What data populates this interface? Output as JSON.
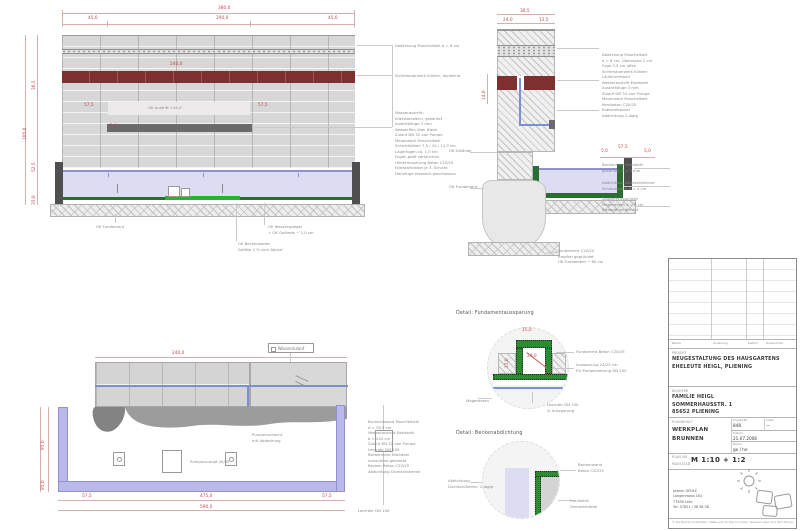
{
  "colors": {
    "dim_red": "#b84b4b",
    "note_gray": "#8a8a8a",
    "water_lavender": "#dcdcf2",
    "basin_purple": "#b9b9ea",
    "liner_green": "#2c6e2f",
    "brick_red": "#7e3030",
    "steel_gray": "#4f4f4f",
    "pipe_blue": "#7b8fd4"
  },
  "details": {
    "d1_title": "Detail: Fundamentaussparung",
    "d2_title": "Detail: Beckenabdichtung"
  },
  "plan": {
    "supply_label": "Wasserzulauf"
  },
  "dims": [
    {
      "text": "380,0",
      "style": "left:218px;top:7px"
    },
    {
      "text": "45,0",
      "style": "left:88px;top:17px"
    },
    {
      "text": "290,0",
      "style": "left:216px;top:17px"
    },
    {
      "text": "45,0",
      "style": "left:328px;top:17px"
    },
    {
      "text": "240,0",
      "style": "left:170px;top:63px"
    },
    {
      "text": "57,5",
      "style": "left:84px;top:104px"
    },
    {
      "text": "57,5",
      "style": "left:258px;top:104px"
    },
    {
      "text": "2,0",
      "style": "left:110px;top:125px"
    },
    {
      "text": "36,5",
      "style": "left:33px;top:90px;transform:rotate(-90deg)"
    },
    {
      "text": "105,0",
      "style": "left:24px;top:140px;transform:rotate(-90deg)"
    },
    {
      "text": "52,5",
      "style": "left:33px;top:172px;transform:rotate(-90deg)"
    },
    {
      "text": "35,0",
      "style": "left:33px;top:205px;transform:rotate(-90deg)"
    },
    {
      "text": "36,5",
      "style": "left:520px;top:10px"
    },
    {
      "text": "24,0",
      "style": "left:503px;top:19px"
    },
    {
      "text": "12,5",
      "style": "left:539px;top:19px"
    },
    {
      "text": "14,0",
      "style": "left:483px;top:100px;transform:rotate(-90deg)"
    },
    {
      "text": "5,0",
      "style": "left:601px;top:150px"
    },
    {
      "text": "57,5",
      "style": "left:618px;top:146px"
    },
    {
      "text": "5,0",
      "style": "left:644px;top:150px"
    },
    {
      "text": "240,0",
      "style": "left:172px;top:352px"
    },
    {
      "text": "95,0",
      "style": "left:42px;top:450px;transform:rotate(-90deg)"
    },
    {
      "text": "85,0",
      "style": "left:42px;top:490px;transform:rotate(-90deg)"
    },
    {
      "text": "57,5",
      "style": "left:82px;top:495px"
    },
    {
      "text": "475,0",
      "style": "left:200px;top:495px"
    },
    {
      "text": "57,5",
      "style": "left:322px;top:495px"
    },
    {
      "text": "590,0",
      "style": "left:200px;top:506px"
    },
    {
      "text": "15,0",
      "style": "left:522px;top:329px"
    },
    {
      "text": "24,0",
      "style": "left:527px;top:355px"
    },
    {
      "text": "15,0",
      "style": "left:506px;top:368px;transform:rotate(-90deg)"
    }
  ],
  "notes": [
    {
      "text": "Abdeckung Muschelkalk d = 8 cm",
      "style": "left:395px;top:43px"
    },
    {
      "text": "Sichtmauerwerk Klinker, dunkelrot",
      "style": "left:395px;top:73px"
    },
    {
      "text": "Wasseraustritt:\nEdelstahlblech, gekantet\nAustrittsfuge 3 mm\nWasserfilm über Blech\nZulauf DN 32 von Pumpe\nMauerwerk Muschelkalk\nSchichthöhen 7,5 / 10 / 12,5 cm\nLagerfugen ca. 1,0 cm\nFugen glatt verstrichen\nHintermauerung Beton C20/25\nEdelstahlanker je 3. Schicht\nDehnfuge elastisch geschlossen",
      "style": "left:395px;top:110px"
    },
    {
      "text": "OK Austritt  +45,0",
      "style": "left:148px;top:105px"
    },
    {
      "text": "OK Wasserspiegel\n= OK Gelände − 2,0 cm",
      "style": "left:268px;top:224px"
    },
    {
      "text": "OK Beckenboden\nGefälle 2 % zum Ablauf",
      "style": "left:238px;top:241px"
    },
    {
      "text": "OK Fundament",
      "style": "left:96px;top:224px"
    },
    {
      "text": "Abdeckung Muschelkalk\nd = 8 cm, Überstand 2 cm\nFuge 0,5 cm offen\nSichtmauerwerk Klinker\nLäuferverband\nWasseraustritt Edelstahl\nAustrittsfuge 3 mm\nZulauf DN 32 von Pumpe\nMauerwerk Muschelkalk\nKernbeton C20/25\nEdelstahlanker\nAbdichtung 2-lagig",
      "style": "left:602px;top:52px"
    },
    {
      "text": "Beckenrand Edelstahl\ngekantet, d = 3 mm",
      "style": "left:602px;top:162px"
    },
    {
      "text": "Abdichtung Dichtschlämme\nSchutzestrich d = 4 cm",
      "style": "left:602px;top:180px"
    },
    {
      "text": "Sauberkeitsschicht\nMagerbeton d = 5 cm\nKiesbett verdichtet",
      "style": "left:602px;top:196px"
    },
    {
      "text": "Fundament C20/25\nfrostfrei gegründet\nUK Fundament − 80 cm",
      "style": "left:558px;top:248px"
    },
    {
      "text": "OK Gelände",
      "style": "left:449px;top:148px"
    },
    {
      "text": "OK Fundament",
      "style": "left:449px;top:184px"
    },
    {
      "text": "Brunnenwand Muschelkalk\nd = 36,5 cm\nWasseraustritt Edelstahl\nb = 240 cm\nZulauf DN 32 von Pumpe\nLeerrohr DN 100\nBeckenrand Edelstahl\numlaufend gekantet\nBecken Beton C20/25\nAbdichtung Dichtschlämme",
      "style": "left:368px;top:419px"
    },
    {
      "text": "Pumpensumpf 40/40",
      "style": "left:190px;top:459px"
    },
    {
      "text": "Pumpenschacht\nmit Abdeckung",
      "style": "left:252px;top:432px"
    },
    {
      "text": "Leerrohr DN 100",
      "style": "left:358px;top:508px"
    },
    {
      "text": "Fundament Beton C20/25",
      "style": "left:576px;top:349px"
    },
    {
      "text": "Aussparung 24/25 cm\nfür Pumpenleitung DN 100",
      "style": "left:576px;top:362px"
    },
    {
      "text": "Magerbeton",
      "style": "left:466px;top:398px"
    },
    {
      "text": "Leerrohr DN 100\nin Aussparung",
      "style": "left:547px;top:402px"
    },
    {
      "text": "Abdichtung\nDichtschlämme, 2-lagig",
      "style": "left:448px;top:478px"
    },
    {
      "text": "Beckenwand\nBeton C20/25",
      "style": "left:578px;top:462px"
    },
    {
      "text": "Hohlkehle\nZementmörtel",
      "style": "left:570px;top:498px"
    }
  ],
  "titleblock": {
    "rev_headers": [
      {
        "text": "Name",
        "style": "left:3px;top:82px"
      },
      {
        "text": "Änderung",
        "style": "left:44px;top:82px"
      },
      {
        "text": "Datum",
        "style": "left:79px;top:82px"
      },
      {
        "text": "Gezeichnet",
        "style": "left:97px;top:82px"
      }
    ],
    "project_label": "PROJEKT",
    "project_text": "NEUGESTALTUNG DES HAUSGARTENS\nEHELEUTE HEIGL, PLIENING",
    "client_label": "BAUHERR",
    "client_text": "FAMILIE HEIGL\nSOMMERHAUSSTR. 1\n85652 PLIENING",
    "content_label": "PLANINHALT",
    "content_text": "WERKPLAN\nBRUNNEN",
    "meta": [
      {
        "label": "Projekt-Nr.",
        "value": "848",
        "style": "left:64px;top:159px;width:29px"
      },
      {
        "label": "Index",
        "value": "—",
        "style": "left:97px;top:159px;width:30px"
      },
      {
        "label": "Datum",
        "value": "21.07.2008",
        "style": "left:64px;top:172px;width:63px"
      },
      {
        "label": "Name",
        "value": "ge / he",
        "style": "left:64px;top:183px;width:63px"
      }
    ],
    "plannr_label": "PLAN-NR.",
    "scale_label": "MASSSTAB",
    "scale_value": "M 1:10 + 1:2",
    "firm_text": "planen GEHLE\nLangenmoos 161\n77839 Lahr\nTel. 07821 / 38 38 38",
    "disclaimer": "© Alle Rechte vorbehalten. Maße sind am Bau zu prüfen, Abweichungen sind dem Planverfasser zu melden."
  }
}
